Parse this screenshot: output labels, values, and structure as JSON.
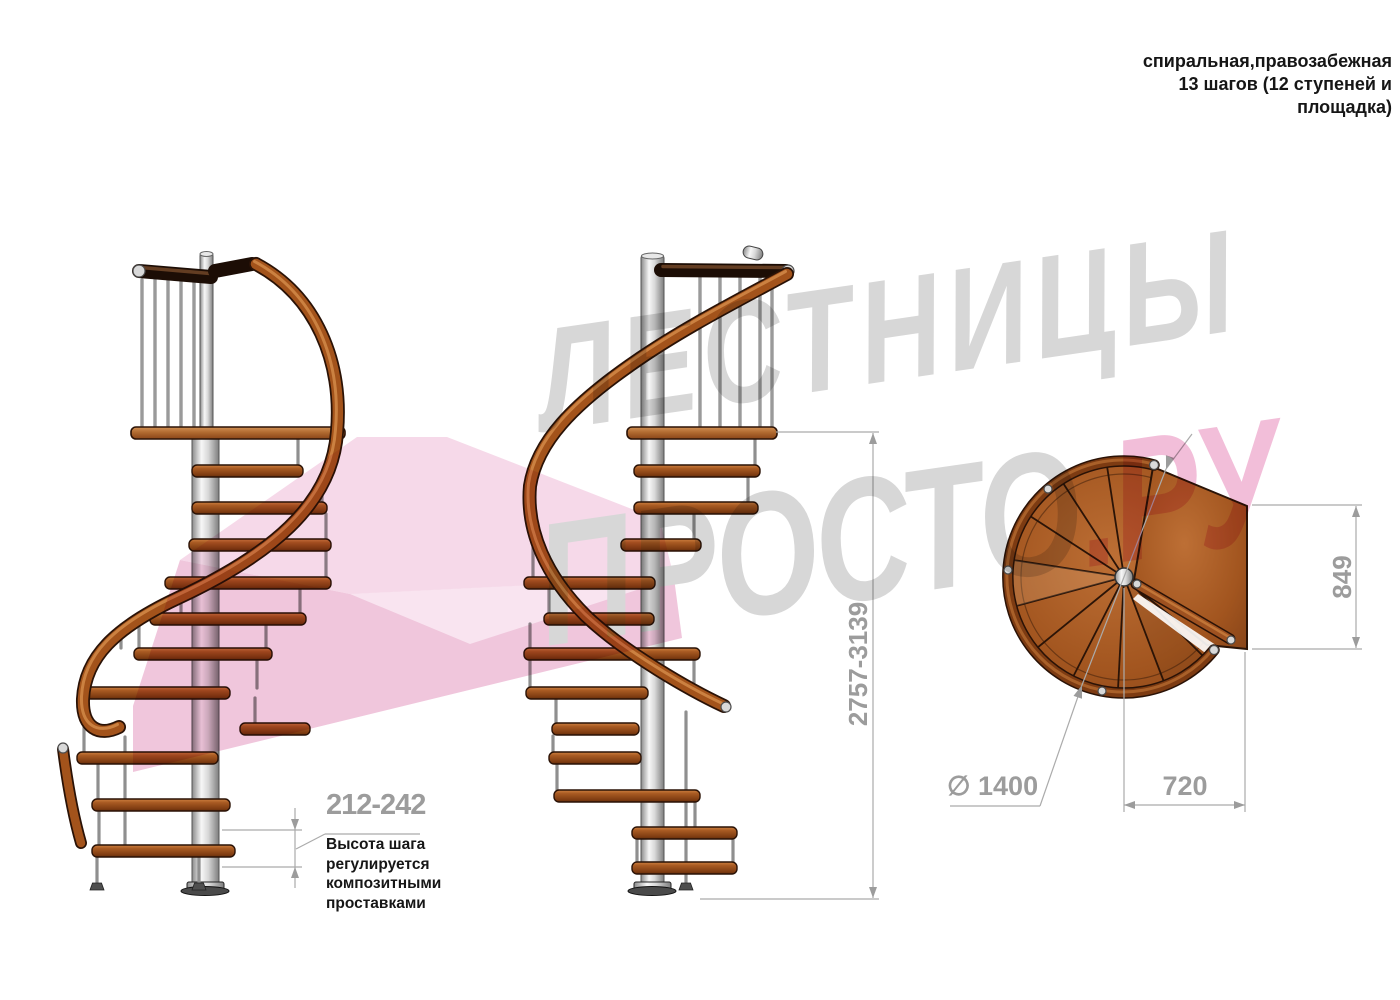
{
  "title": {
    "lines": [
      "спиральная,правозабежная",
      "13 шагов (12 ступеней и",
      "площадка)"
    ]
  },
  "watermark": {
    "word1": "ЛЕСТНИЦЫ",
    "word2": "ПРОСТО",
    "word2_suffix": ".РУ",
    "gray": "#d7d7d7",
    "pink": "#f2bed9"
  },
  "dimensions": {
    "step_height": {
      "value": "212-242",
      "note": [
        "Высота шага",
        "регулируется",
        "композитными",
        "проставками"
      ]
    },
    "total_height": {
      "value": "2757-3139"
    },
    "platform_depth": {
      "value": "849"
    },
    "platform_width": {
      "value": "720"
    },
    "diameter": {
      "value": "∅ 1400"
    }
  },
  "colors": {
    "dim_text": "#9c9c9c",
    "dim_line": "#ababab",
    "annotation_text": "#161616",
    "wood": "#a85a22",
    "handrail": "#a3531b",
    "dark_rail": "#1c0d05",
    "column_silver": "#d8d8d8",
    "watermark_gray": "#d7d7d7",
    "watermark_pink": "#f2bed9"
  },
  "icons": {
    "diameter_symbol": "∅"
  }
}
